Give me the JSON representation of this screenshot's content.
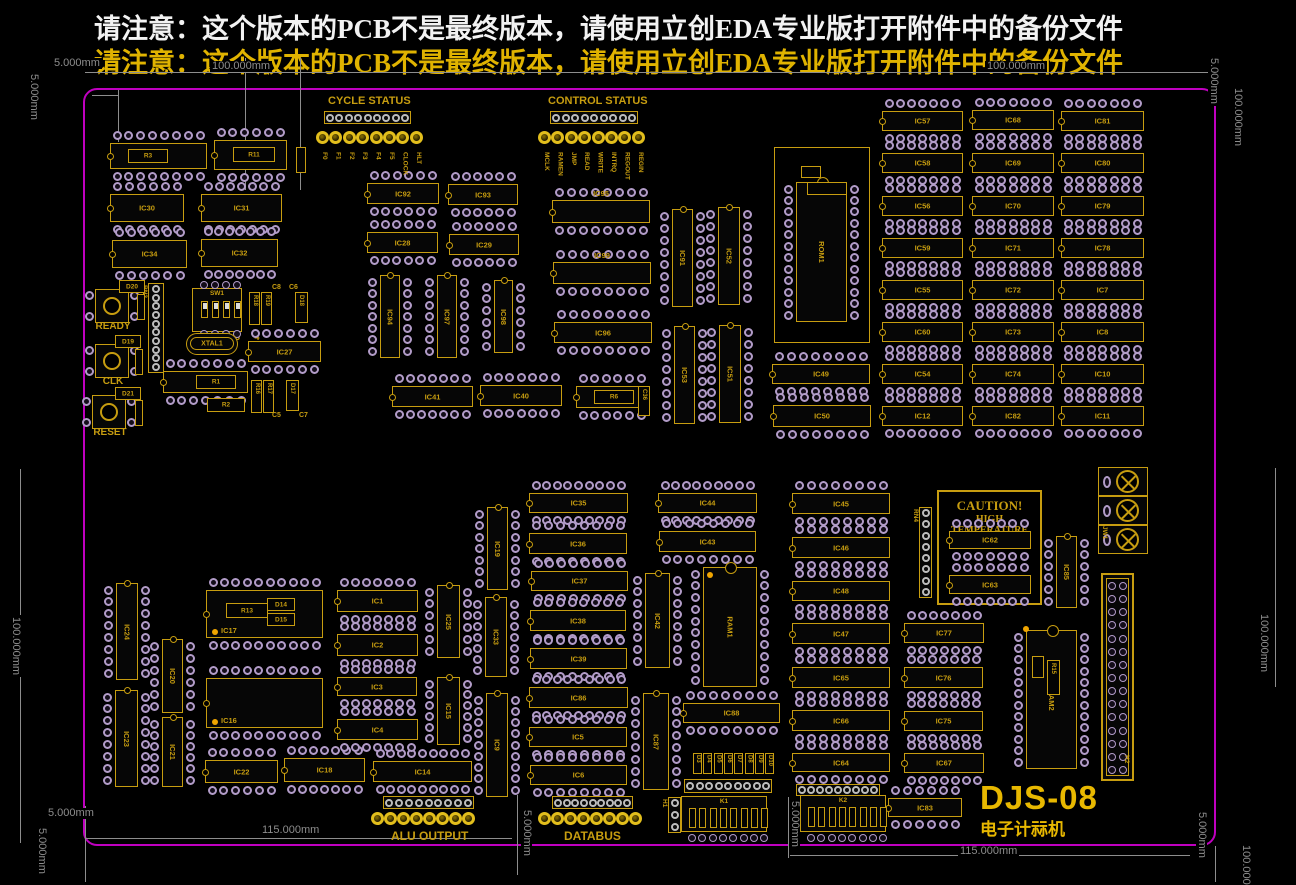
{
  "texts": {
    "warning_line1": "请注意：这个版本的PCB不是最终版本，请使用立创EDA专业版打开附件中的备份文件",
    "warning_line2": "请注意：这个版本的PCB不是最终版本，请使用立创EDA专业版打开附件中的备份文件",
    "cycle_status": "CYCLE STATUS",
    "control_status": "CONTROL STATUS",
    "alu_output": "ALU OUTPUT",
    "databus": "DATABUS",
    "sw1_numbers": "1 2 3 4",
    "caution_title": "CAUTION!",
    "caution_sub": "HIGH TEMPERATURE",
    "title": "DJS-08",
    "subtitle": "电子计祘机",
    "c8": "C8",
    "c6": "C6",
    "c5": "C5",
    "c7": "C7"
  },
  "colors": {
    "silkscreen": "#c79d10",
    "board_outline": "#c000c0",
    "pad_ring": "#b29cc8",
    "hole_ring": "#bdbdbd",
    "dimension": "#8d8d8d",
    "led": "#e2be1c",
    "warning_top": "#f2f2f2",
    "warning_bottom": "#e0b300",
    "title": "#e8b800"
  },
  "board": {
    "x": 83,
    "y": 88,
    "w": 1133,
    "h": 758
  },
  "silk_texts": [
    {
      "key": "cycle_status",
      "x": 328,
      "y": 95,
      "size": 11
    },
    {
      "key": "control_status",
      "x": 548,
      "y": 95,
      "size": 11
    },
    {
      "key": "alu_output",
      "x": 391,
      "y": 829,
      "size": 12
    },
    {
      "key": "databus",
      "x": 564,
      "y": 829,
      "size": 12
    },
    {
      "key": "sw1_numbers",
      "x": 196,
      "y": 332,
      "size": 9
    },
    {
      "key": "c8",
      "x": 272,
      "y": 284,
      "size": 7
    },
    {
      "key": "c6",
      "x": 289,
      "y": 284,
      "size": 7
    },
    {
      "key": "c5",
      "x": 272,
      "y": 412,
      "size": 7
    },
    {
      "key": "c7",
      "x": 299,
      "y": 412,
      "size": 7
    }
  ],
  "ics_h": [
    [
      "IC13",
      110,
      143,
      97,
      26
    ],
    [
      "IC84",
      214,
      140,
      73,
      30
    ],
    [
      "IC30",
      110,
      194,
      74,
      28
    ],
    [
      "IC31",
      201,
      194,
      81,
      28
    ],
    [
      "IC34",
      112,
      240,
      75,
      28
    ],
    [
      "IC32",
      201,
      239,
      77,
      28
    ],
    [
      "IC92",
      367,
      183,
      72,
      21
    ],
    [
      "IC93",
      448,
      184,
      70,
      21
    ],
    [
      "IC28",
      367,
      232,
      71,
      21
    ],
    [
      "IC29",
      449,
      234,
      70,
      21
    ],
    [
      "IC26",
      163,
      371,
      85,
      22
    ],
    [
      "IC27",
      248,
      341,
      73,
      21
    ],
    [
      "IC41",
      392,
      386,
      81,
      21
    ],
    [
      "IC40",
      480,
      385,
      82,
      21
    ],
    [
      "IC61",
      576,
      386,
      72,
      22
    ],
    [
      "IC95",
      552,
      200,
      98,
      23,
      "a"
    ],
    [
      "IC99",
      553,
      262,
      98,
      22,
      "a"
    ],
    [
      "IC96",
      554,
      322,
      98,
      21
    ],
    [
      "IC49",
      772,
      364,
      98,
      20
    ],
    [
      "IC50",
      773,
      405,
      98,
      22
    ],
    [
      "IC57",
      882,
      111,
      81,
      20
    ],
    [
      "IC68",
      972,
      110,
      82,
      20
    ],
    [
      "IC81",
      1061,
      111,
      83,
      20
    ],
    [
      "IC58",
      882,
      153,
      81,
      20
    ],
    [
      "IC69",
      972,
      153,
      82,
      20
    ],
    [
      "IC80",
      1061,
      153,
      83,
      20
    ],
    [
      "IC56",
      882,
      196,
      81,
      20
    ],
    [
      "IC70",
      972,
      196,
      82,
      20
    ],
    [
      "IC79",
      1061,
      196,
      83,
      20
    ],
    [
      "IC59",
      882,
      238,
      81,
      20
    ],
    [
      "IC71",
      972,
      238,
      82,
      20
    ],
    [
      "IC78",
      1061,
      238,
      83,
      20
    ],
    [
      "IC55",
      882,
      280,
      81,
      20
    ],
    [
      "IC72",
      972,
      280,
      82,
      20
    ],
    [
      "IC7",
      1061,
      280,
      83,
      20
    ],
    [
      "IC60",
      882,
      322,
      81,
      20
    ],
    [
      "IC73",
      972,
      322,
      82,
      20
    ],
    [
      "IC8",
      1061,
      322,
      83,
      20
    ],
    [
      "IC54",
      882,
      364,
      81,
      20
    ],
    [
      "IC74",
      972,
      364,
      82,
      20
    ],
    [
      "IC10",
      1061,
      364,
      83,
      20
    ],
    [
      "IC12",
      882,
      406,
      81,
      20
    ],
    [
      "IC82",
      972,
      406,
      82,
      20
    ],
    [
      "IC11",
      1061,
      406,
      83,
      20
    ],
    [
      "IC17",
      206,
      590,
      117,
      48,
      "bl"
    ],
    [
      "IC16",
      206,
      678,
      117,
      50,
      "bl"
    ],
    [
      "IC22",
      205,
      760,
      73,
      23
    ],
    [
      "IC18",
      284,
      758,
      81,
      24
    ],
    [
      "IC14",
      373,
      761,
      99,
      21
    ],
    [
      "IC1",
      337,
      590,
      81,
      22
    ],
    [
      "IC2",
      337,
      634,
      81,
      22
    ],
    [
      "IC3",
      337,
      677,
      80,
      19
    ],
    [
      "IC4",
      337,
      719,
      81,
      21
    ],
    [
      "IC35",
      529,
      493,
      99,
      20
    ],
    [
      "IC36",
      529,
      533,
      98,
      21
    ],
    [
      "IC37",
      531,
      571,
      97,
      20
    ],
    [
      "IC38",
      530,
      610,
      96,
      21
    ],
    [
      "IC39",
      530,
      648,
      97,
      21
    ],
    [
      "IC86",
      529,
      687,
      99,
      21
    ],
    [
      "IC5",
      529,
      727,
      98,
      20
    ],
    [
      "IC6",
      530,
      765,
      97,
      20
    ],
    [
      "IC44",
      658,
      493,
      99,
      20
    ],
    [
      "IC43",
      659,
      531,
      97,
      21
    ],
    [
      "IC88",
      683,
      703,
      97,
      20
    ],
    [
      "IC45",
      792,
      493,
      98,
      21
    ],
    [
      "IC46",
      792,
      537,
      98,
      21
    ],
    [
      "IC48",
      792,
      581,
      98,
      20
    ],
    [
      "IC47",
      792,
      623,
      98,
      21
    ],
    [
      "IC65",
      792,
      667,
      98,
      21
    ],
    [
      "IC66",
      792,
      710,
      98,
      21
    ],
    [
      "IC64",
      792,
      753,
      98,
      19
    ],
    [
      "IC77",
      904,
      623,
      80,
      20
    ],
    [
      "IC76",
      904,
      667,
      79,
      21
    ],
    [
      "IC75",
      904,
      711,
      79,
      20
    ],
    [
      "IC67",
      904,
      753,
      80,
      20
    ],
    [
      "IC83",
      888,
      798,
      74,
      19
    ],
    [
      "IC62",
      949,
      531,
      82,
      18
    ],
    [
      "IC63",
      949,
      575,
      82,
      19
    ]
  ],
  "ics_v": [
    [
      "IC94",
      380,
      275,
      20,
      83
    ],
    [
      "IC97",
      437,
      275,
      20,
      83
    ],
    [
      "IC98",
      494,
      280,
      19,
      73
    ],
    [
      "IC91",
      672,
      209,
      21,
      98
    ],
    [
      "IC52",
      718,
      207,
      22,
      98
    ],
    [
      "IC53",
      674,
      326,
      21,
      98
    ],
    [
      "IC51",
      719,
      325,
      22,
      98
    ],
    [
      "IC25",
      437,
      585,
      23,
      73
    ],
    [
      "IC15",
      437,
      677,
      23,
      68
    ],
    [
      "IC19",
      487,
      507,
      21,
      83
    ],
    [
      "IC33",
      485,
      597,
      22,
      80
    ],
    [
      "IC9",
      486,
      693,
      22,
      104
    ],
    [
      "IC24",
      116,
      583,
      22,
      97
    ],
    [
      "IC23",
      115,
      690,
      23,
      97
    ],
    [
      "IC20",
      162,
      639,
      21,
      74
    ],
    [
      "IC21",
      162,
      717,
      21,
      70
    ],
    [
      "IC42",
      645,
      573,
      25,
      95
    ],
    [
      "IC87",
      643,
      693,
      26,
      97
    ],
    [
      "IC85",
      1056,
      536,
      21,
      72
    ]
  ],
  "big_chips": [
    {
      "label": "ROM1",
      "x": 796,
      "y": 182,
      "w": 51,
      "h": 140,
      "outer": [
        774,
        147,
        96,
        196
      ]
    },
    {
      "label": "RAM1",
      "x": 703,
      "y": 567,
      "w": 54,
      "h": 120
    },
    {
      "label": "RAM2",
      "x": 1026,
      "y": 630,
      "w": 51,
      "h": 139
    }
  ],
  "led_groups": [
    {
      "name": "cycle-status-leds",
      "x": 316,
      "y": 131,
      "count": 8,
      "spacing": 13.4,
      "labels": [
        "F0",
        "F1",
        "F2",
        "F3",
        "F4",
        "F5",
        "CLOCK",
        "HLT"
      ]
    },
    {
      "name": "control-status-leds",
      "x": 538,
      "y": 131,
      "count": 8,
      "spacing": 13.4,
      "labels": [
        "MCLK",
        "RAMEN",
        "JMP",
        "READ",
        "WRITE",
        "INTRQ",
        "REGOUT",
        "REGIN"
      ]
    },
    {
      "name": "alu-output-leds",
      "x": 371,
      "y": 812,
      "count": 8,
      "spacing": 13,
      "labels": []
    },
    {
      "name": "databus-leds",
      "x": 538,
      "y": 812,
      "count": 8,
      "spacing": 13,
      "labels": []
    }
  ],
  "buttons": [
    {
      "label": "READY",
      "x": 95,
      "y": 289
    },
    {
      "label": "CLK",
      "x": 95,
      "y": 344
    },
    {
      "label": "RESET",
      "x": 92,
      "y": 395
    }
  ],
  "sw1": {
    "label": "SW1",
    "x": 192,
    "y": 288,
    "w": 50,
    "h": 44
  },
  "xtal": {
    "label": "XTAL1",
    "x": 186,
    "y": 333,
    "w": 52,
    "h": 22
  },
  "screw_terminal": {
    "label": "JW1",
    "x": 1098,
    "y": 467,
    "w": 50,
    "h": 87
  },
  "idc": {
    "label": "H2",
    "x": 1101,
    "y": 573,
    "w": 33,
    "h": 208
  },
  "networks": [
    {
      "label": "K1",
      "x": 681,
      "y": 796,
      "w": 86,
      "h": 36
    },
    {
      "label": "K2",
      "x": 800,
      "y": 795,
      "w": 86,
      "h": 37
    }
  ],
  "d_array": {
    "labels": [
      "D3",
      "D4",
      "D5",
      "D6",
      "D7",
      "D8",
      "D9",
      "D10"
    ],
    "x": 693,
    "y": 753,
    "w": 9,
    "h": 21,
    "gap": 10.3
  },
  "connectors_h": [
    [
      324,
      111,
      87,
      13,
      9
    ],
    [
      550,
      111,
      88,
      13,
      9
    ],
    [
      383,
      796,
      91,
      13,
      9
    ],
    [
      552,
      796,
      81,
      13,
      9
    ],
    [
      684,
      779,
      88,
      14,
      9
    ],
    [
      796,
      784,
      84,
      12,
      9
    ]
  ],
  "connectors_v": [
    {
      "label": "RN3",
      "x": 148,
      "y": 283,
      "w": 16,
      "h": 90,
      "holes": 10
    },
    {
      "label": "RN4",
      "x": 919,
      "y": 507,
      "w": 13,
      "h": 91,
      "holes": 8
    },
    {
      "label": "H1",
      "x": 668,
      "y": 797,
      "w": 13,
      "h": 36,
      "holes": 3
    }
  ],
  "small_parts": [
    {
      "label": "R3",
      "x": 128,
      "y": 149,
      "w": 40,
      "h": 14
    },
    {
      "label": "R11",
      "x": 233,
      "y": 147,
      "w": 42,
      "h": 15
    },
    {
      "label": "R1",
      "x": 196,
      "y": 375,
      "w": 40,
      "h": 14
    },
    {
      "label": "R2",
      "x": 207,
      "y": 398,
      "w": 38,
      "h": 14
    },
    {
      "label": "R6",
      "x": 594,
      "y": 390,
      "w": 40,
      "h": 14
    },
    {
      "label": "R13",
      "x": 226,
      "y": 603,
      "w": 42,
      "h": 15
    },
    {
      "label": "D14",
      "x": 267,
      "y": 598,
      "w": 28,
      "h": 13
    },
    {
      "label": "D15",
      "x": 267,
      "y": 613,
      "w": 28,
      "h": 13
    },
    {
      "label": "D20",
      "x": 119,
      "y": 280,
      "w": 26,
      "h": 13
    },
    {
      "label": "D19",
      "x": 115,
      "y": 335,
      "w": 26,
      "h": 13
    },
    {
      "label": "D21",
      "x": 115,
      "y": 387,
      "w": 26,
      "h": 13
    },
    {
      "label": "R18",
      "x": 249,
      "y": 292,
      "w": 11,
      "h": 33,
      "rot": 1
    },
    {
      "label": "R19",
      "x": 261,
      "y": 292,
      "w": 11,
      "h": 33,
      "rot": 1
    },
    {
      "label": "D18",
      "x": 295,
      "y": 292,
      "w": 13,
      "h": 31,
      "rot": 1
    },
    {
      "label": "R16",
      "x": 251,
      "y": 380,
      "w": 11,
      "h": 33,
      "rot": 1
    },
    {
      "label": "R17",
      "x": 263,
      "y": 380,
      "w": 11,
      "h": 33,
      "rot": 1
    },
    {
      "label": "D17",
      "x": 286,
      "y": 380,
      "w": 13,
      "h": 31,
      "rot": 1
    },
    {
      "label": "R15",
      "x": 1047,
      "y": 660,
      "w": 13,
      "h": 35,
      "rot": 1
    },
    {
      "label": "C36",
      "x": 638,
      "y": 386,
      "w": 12,
      "h": 30,
      "rot": 1
    },
    {
      "label": "",
      "x": 801,
      "y": 166,
      "w": 20,
      "h": 12
    },
    {
      "label": "",
      "x": 807,
      "y": 182,
      "w": 40,
      "h": 13
    },
    {
      "label": "",
      "x": 296,
      "y": 147,
      "w": 10,
      "h": 26,
      "rot": 1
    },
    {
      "label": "",
      "x": 137,
      "y": 294,
      "w": 8,
      "h": 26,
      "rot": 1
    },
    {
      "label": "",
      "x": 135,
      "y": 349,
      "w": 8,
      "h": 26,
      "rot": 1
    },
    {
      "label": "",
      "x": 135,
      "y": 400,
      "w": 8,
      "h": 26,
      "rot": 1
    },
    {
      "label": "",
      "x": 1032,
      "y": 656,
      "w": 12,
      "h": 22,
      "rot": 1
    }
  ],
  "dots": [
    [
      212,
      629
    ],
    [
      212,
      719
    ],
    [
      707,
      572
    ],
    [
      1023,
      626
    ]
  ],
  "dims": {
    "lines": [
      [
        85,
        72,
        1215,
        72
      ],
      [
        245,
        58,
        245,
        190
      ],
      [
        300,
        58,
        300,
        190
      ],
      [
        118,
        90,
        118,
        142
      ],
      [
        92,
        95,
        118,
        95
      ],
      [
        20,
        469,
        20,
        843
      ],
      [
        1275,
        468,
        1275,
        687
      ],
      [
        85,
        838,
        512,
        838
      ],
      [
        517,
        795,
        517,
        875
      ],
      [
        788,
        797,
        788,
        858
      ],
      [
        790,
        855,
        1190,
        855
      ],
      [
        85,
        806,
        85,
        882
      ],
      [
        1215,
        846,
        1215,
        882
      ]
    ],
    "labels": [
      [
        "100.000mm",
        210,
        61,
        0
      ],
      [
        "100.000mm",
        985,
        61,
        0
      ],
      [
        "5.000mm",
        52,
        58,
        0
      ],
      [
        "5.000mm",
        28,
        72,
        1
      ],
      [
        "5.000mm",
        1208,
        56,
        1
      ],
      [
        "100.000mm",
        1232,
        86,
        1
      ],
      [
        "100.000mm",
        10,
        615,
        1
      ],
      [
        "100.000mm",
        1258,
        612,
        1
      ],
      [
        "115.000mm",
        260,
        825,
        0
      ],
      [
        "115.000mm",
        958,
        846,
        0
      ],
      [
        "5.000mm",
        46,
        808,
        0
      ],
      [
        "5.000mm",
        36,
        826,
        1
      ],
      [
        "5.000mm",
        521,
        808,
        1
      ],
      [
        "5.000mm",
        789,
        799,
        1
      ],
      [
        "5.000mm",
        1196,
        810,
        1
      ],
      [
        "100.000mm",
        1240,
        843,
        1
      ]
    ]
  }
}
